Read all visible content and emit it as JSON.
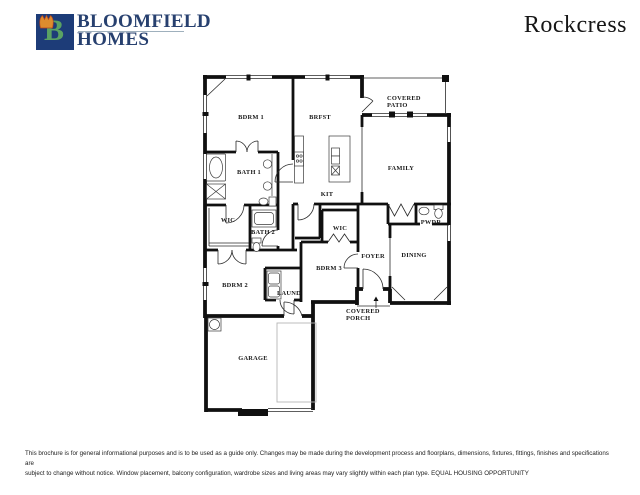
{
  "header": {
    "brand_line1": "BLOOMFIELD",
    "brand_line2": "HOMES",
    "logo_letter": "B",
    "plan_name": "Rockcress"
  },
  "floor_plan": {
    "rooms": {
      "bdrm1": "BDRM 1",
      "brfst": "BRFST",
      "patio1": "COVERED",
      "patio2": "PATIO",
      "family": "FAMILY",
      "bath1": "BATH 1",
      "kit": "KIT",
      "wic1": "WIC",
      "bath2": "BATH 2",
      "wic2": "WIC",
      "pwdr": "PWDR",
      "foyer": "FOYER",
      "dining": "DINING",
      "bdrm2": "BDRM 2",
      "laund": "LAUND",
      "bdrm3": "BDRM 3",
      "porch1": "COVERED",
      "porch2": "PORCH",
      "garage": "GARAGE"
    }
  },
  "footer": {
    "line1": "This brochure is for general informational purposes and is to be used as a guide only. Changes may be made during the development process and floorplans, dimensions, fixtures, fittings, finishes and specifications are",
    "line2": "subject to change without notice. Window placement, balcony configuration, wardrobe sizes and living areas may vary slightly within each plan type.  EQUAL HOUSING OPPORTUNITY"
  },
  "colors": {
    "brand_navy": "#27406f",
    "logo_blue": "#1d3c78",
    "logo_green": "#5aa263",
    "tulip_orange": "#dd8c2e",
    "wall_black": "#101010"
  }
}
